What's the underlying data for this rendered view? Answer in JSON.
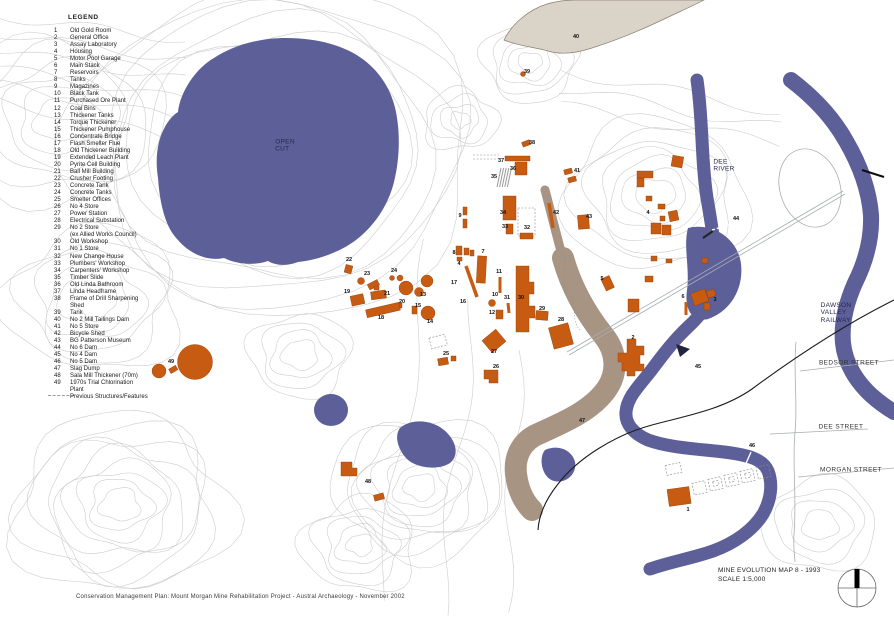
{
  "colors": {
    "water": "#5d5f99",
    "building": "#c75b12",
    "slag_dump": "#a79482",
    "tailings_dam": "#d9d3c8",
    "contour": "#cdcdcd",
    "road": "#a8adb0",
    "railway": "#1c1c1c",
    "text": "#1a1a1a"
  },
  "legend": {
    "title": "LEGEND",
    "items": [
      {
        "n": "1",
        "label": "Old Gold Room"
      },
      {
        "n": "2",
        "label": "General Office"
      },
      {
        "n": "3",
        "label": "Assay Laboratory"
      },
      {
        "n": "4",
        "label": "Housing"
      },
      {
        "n": "5",
        "label": "Motor Pool Garage"
      },
      {
        "n": "6",
        "label": "Main Stack"
      },
      {
        "n": "7",
        "label": "Reservoirs"
      },
      {
        "n": "8",
        "label": "Tanks"
      },
      {
        "n": "9",
        "label": "Magazines"
      },
      {
        "n": "10",
        "label": "Black Tank"
      },
      {
        "n": "11",
        "label": "Purchased Ore Plant"
      },
      {
        "n": "12",
        "label": "Coal Bins"
      },
      {
        "n": "13",
        "label": "Thickener Tanks"
      },
      {
        "n": "14",
        "label": "Torque Thickener"
      },
      {
        "n": "15",
        "label": "Thickener Pumphouse"
      },
      {
        "n": "16",
        "label": "Concentrate Bridge"
      },
      {
        "n": "17",
        "label": "Flash Smelter Flue"
      },
      {
        "n": "18",
        "label": "Old Thickener Building"
      },
      {
        "n": "19",
        "label": "Extended Leach Plant"
      },
      {
        "n": "20",
        "label": "Pyrite Cell Building"
      },
      {
        "n": "21",
        "label": "Ball Mill Building"
      },
      {
        "n": "22",
        "label": "Crusher Footing"
      },
      {
        "n": "23",
        "label": "Concrete Tank"
      },
      {
        "n": "24",
        "label": "Concrete Tanks"
      },
      {
        "n": "25",
        "label": "Smelter Offices"
      },
      {
        "n": "26",
        "label": "No 4 Store"
      },
      {
        "n": "27",
        "label": "Power Station"
      },
      {
        "n": "28",
        "label": "Electrical Substation"
      },
      {
        "n": "29",
        "label": "No 2 Store",
        "label2": "(ex Allied Works Council)"
      },
      {
        "n": "30",
        "label": "Old Workshop"
      },
      {
        "n": "31",
        "label": "No 1 Store"
      },
      {
        "n": "32",
        "label": "New Change House"
      },
      {
        "n": "33",
        "label": "Plumbers' Workshop"
      },
      {
        "n": "34",
        "label": "Carpenters' Workshop"
      },
      {
        "n": "35",
        "label": "Timber Slide"
      },
      {
        "n": "36",
        "label": "Old Linda Bathroom"
      },
      {
        "n": "37",
        "label": "Linda Headframe"
      },
      {
        "n": "38",
        "label": "Frame of Drill Sharpening",
        "label2": "Shed"
      },
      {
        "n": "39",
        "label": "Tank"
      },
      {
        "n": "40",
        "label": "No 2 Mill Tailings Dam"
      },
      {
        "n": "41",
        "label": "No 5 Store"
      },
      {
        "n": "42",
        "label": "Bicycle Shed"
      },
      {
        "n": "43",
        "label": "BG Patterson Museum"
      },
      {
        "n": "44",
        "label": "No 6 Dam"
      },
      {
        "n": "45",
        "label": "No 4 Dam"
      },
      {
        "n": "46",
        "label": "No 5 Dam"
      },
      {
        "n": "47",
        "label": "Slag Dump"
      },
      {
        "n": "48",
        "label": "Sala Mill Thickener (70m)"
      },
      {
        "n": "49",
        "label": "1970s Trial Chlorination",
        "label2": "Plant"
      }
    ],
    "previous_label": "Previous Structures/Features"
  },
  "map": {
    "labels": [
      {
        "t": "OPEN\nCUT",
        "x": 285,
        "y": 146,
        "cls": "place"
      },
      {
        "t": "DEE\nRIVER",
        "x": 724,
        "y": 166,
        "cls": "place"
      },
      {
        "t": "DAWSON\nVALLEY\nRAILWAY",
        "x": 836,
        "y": 313,
        "cls": "place"
      },
      {
        "t": "BEDSOR STREET",
        "x": 849,
        "y": 363,
        "cls": "street"
      },
      {
        "t": "DEE STREET",
        "x": 841,
        "y": 427,
        "cls": "street"
      },
      {
        "t": "MORGAN STREET",
        "x": 851,
        "y": 470,
        "cls": "street"
      },
      {
        "t": "1",
        "x": 688,
        "y": 510
      },
      {
        "t": "2",
        "x": 633,
        "y": 338
      },
      {
        "t": "3",
        "x": 715,
        "y": 300
      },
      {
        "t": "4",
        "x": 648,
        "y": 213
      },
      {
        "t": "4",
        "x": 459,
        "y": 264
      },
      {
        "t": "5",
        "x": 602,
        "y": 279
      },
      {
        "t": "6",
        "x": 683,
        "y": 297
      },
      {
        "t": "7",
        "x": 483,
        "y": 252
      },
      {
        "t": "8",
        "x": 454,
        "y": 253
      },
      {
        "t": "9",
        "x": 460,
        "y": 216
      },
      {
        "t": "10",
        "x": 495,
        "y": 295
      },
      {
        "t": "11",
        "x": 499,
        "y": 272
      },
      {
        "t": "12",
        "x": 492,
        "y": 313
      },
      {
        "t": "13",
        "x": 423,
        "y": 295
      },
      {
        "t": "14",
        "x": 430,
        "y": 322
      },
      {
        "t": "15",
        "x": 418,
        "y": 306
      },
      {
        "t": "16",
        "x": 463,
        "y": 302
      },
      {
        "t": "17",
        "x": 454,
        "y": 283
      },
      {
        "t": "18",
        "x": 381,
        "y": 318
      },
      {
        "t": "19",
        "x": 347,
        "y": 292
      },
      {
        "t": "20",
        "x": 402,
        "y": 302
      },
      {
        "t": "21",
        "x": 387,
        "y": 294
      },
      {
        "t": "22",
        "x": 349,
        "y": 260
      },
      {
        "t": "23",
        "x": 367,
        "y": 274
      },
      {
        "t": "24",
        "x": 394,
        "y": 271
      },
      {
        "t": "25",
        "x": 446,
        "y": 354
      },
      {
        "t": "26",
        "x": 496,
        "y": 367
      },
      {
        "t": "27",
        "x": 494,
        "y": 352
      },
      {
        "t": "28",
        "x": 561,
        "y": 320
      },
      {
        "t": "29",
        "x": 542,
        "y": 309
      },
      {
        "t": "30",
        "x": 521,
        "y": 298
      },
      {
        "t": "31",
        "x": 507,
        "y": 298
      },
      {
        "t": "32",
        "x": 527,
        "y": 228
      },
      {
        "t": "33",
        "x": 505,
        "y": 227
      },
      {
        "t": "34",
        "x": 503,
        "y": 213
      },
      {
        "t": "35",
        "x": 494,
        "y": 177
      },
      {
        "t": "36",
        "x": 513,
        "y": 169
      },
      {
        "t": "37",
        "x": 501,
        "y": 161
      },
      {
        "t": "38",
        "x": 532,
        "y": 143
      },
      {
        "t": "39",
        "x": 527,
        "y": 72
      },
      {
        "t": "40",
        "x": 576,
        "y": 37
      },
      {
        "t": "41",
        "x": 577,
        "y": 171
      },
      {
        "t": "42",
        "x": 556,
        "y": 213
      },
      {
        "t": "43",
        "x": 589,
        "y": 217
      },
      {
        "t": "44",
        "x": 736,
        "y": 219
      },
      {
        "t": "45",
        "x": 698,
        "y": 367
      },
      {
        "t": "46",
        "x": 752,
        "y": 446
      },
      {
        "t": "47",
        "x": 582,
        "y": 421
      },
      {
        "t": "48",
        "x": 368,
        "y": 482
      },
      {
        "t": "49",
        "x": 171,
        "y": 362
      }
    ]
  },
  "title_block": {
    "line1": "MINE EVOLUTION MAP 8 - 1993",
    "line2": "SCALE 1:5,000"
  },
  "footer": "Conservation Management Plan: Mount Morgan Mine Rehabilitation Project - Austral Archaeology - November 2002"
}
